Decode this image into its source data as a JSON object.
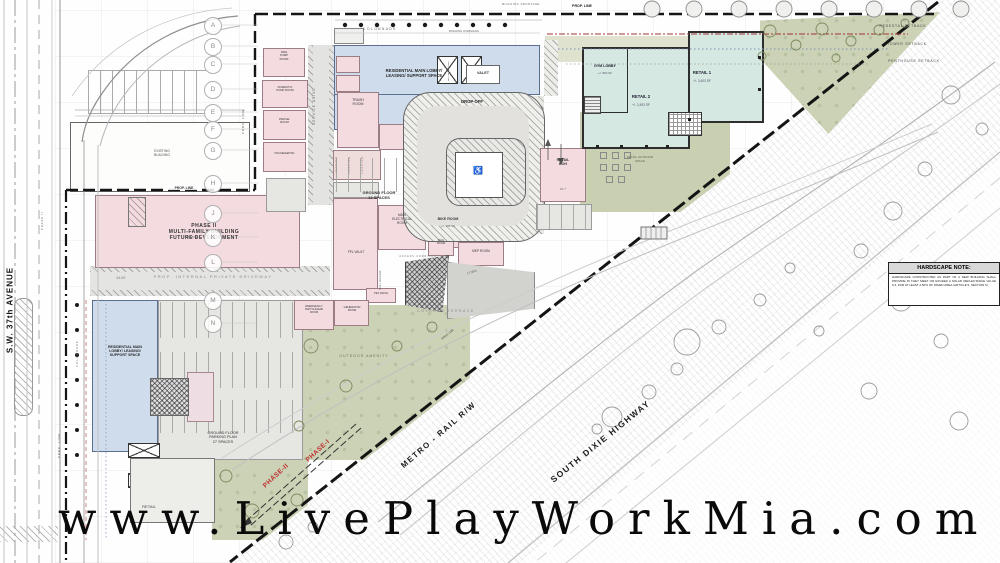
{
  "watermark": "www.LivePlayWorkMia.com",
  "roads": {
    "sw37": "S.W. 37th AVENUE",
    "metro": "METRO - RAIL  R/W",
    "dixie": "SOUTH DIXIE HIGHWAY",
    "colonnade_top": "COLONNADE",
    "colonnade_left": "COLONNADE",
    "service_drive": "SERVICE DRIVE",
    "internal_driveway": "PROP.  INTERNAL  PRIVATE  DRIVEWAY"
  },
  "boundary": {
    "prop_line": "PROP. LINE",
    "building_frontage": "BUILDING FRONTAGE",
    "building_overhang": "BUILDING OVERHANG",
    "pedestal_setback": "PEDESTAL SETBACK",
    "tower_setback": "TOWER SETBACK",
    "penthouse_setback": "PENTHOUSE SETBACK"
  },
  "phase": {
    "phase2": "PHASE-II",
    "phase1": "PHASE-I",
    "phase2_small": "PHASE II"
  },
  "grid_letters": [
    "A",
    "B",
    "C",
    "D",
    "E",
    "F",
    "G",
    "H",
    "J",
    "K",
    "L",
    "M",
    "N"
  ],
  "buildings": {
    "existing": "EXISTING\nBUILDING",
    "phase2_future": "PHASE II\nMULTI-FAMILY BUILDING\nFUTURE DEVELOPMENT",
    "res_lobby_top": "RESIDENTIAL MAIN LOBBY/\nLEASING/ SUPPORT SPACE",
    "res_lobby_left": "RESIDENTIAL MAIN\nLOBBY/ LEASING/\nSUPPORT SPACE",
    "gym_lobby": "GYM LOBBY",
    "gym_lobby_area": "+/- 952 SF",
    "retail1": "RETAIL 1",
    "retail1_area": "+/- 3,403 SF",
    "retail2": "RETAIL 2",
    "retail2_area": "+/- 2,493 SF",
    "retail_boh": "RETAIL\nBOH",
    "retail_bottom": "RETAIL"
  },
  "rooms": {
    "trash": "TRASH\nROOM",
    "fire_pump": "FIRE\nPUMP\nROOM",
    "domestic_pump": "DOMESTIC\nPUMP ROOM",
    "parcel": "PARCEL\nROOM",
    "housekeeping": "HOUSEKEEPING",
    "main_electrical": "MAIN\nELECTRICAL\nROOM",
    "fpl_vault": "FPL VAULT",
    "bike": "BIKE ROOM",
    "bike_area": "+/- 436 SF",
    "bag": "BAG\nROOM",
    "mep": "MEP ROOM",
    "pet_wash": "PET WASH",
    "generator": "GENERATOR\nROOM",
    "emergency": "EMERGENCY\nSWITCHGEAR\nROOM",
    "access_corridor": "ACCESS CORRIDOR",
    "mail_package": "MAIL / PACKAGE",
    "valet": "VALET",
    "res_elev": "RES. ELEV. LOBBY",
    "loading": "LOADING",
    "service": "SERVICE"
  },
  "areas": {
    "drop_off": "DROP-OFF",
    "ground_12": "GROUND FLOOR\n12 SPACES",
    "parking_27": "GROUND FLOOR\nPARKING PLAN\n27 SPACES",
    "outdoor_amenity": "OUTDOOR AMENITY",
    "covered_terrace": "COVERED TERRACE",
    "retail_outdoor": "RETAIL OUTDOOR\nSPACE"
  },
  "dims": {
    "driveway": "24.00'",
    "boh": "28.7'",
    "ramp": "17.35%"
  },
  "note": {
    "title": "HARDSCAPE NOTE:",
    "body": "HARDSCAPE CONSTRUCTED AS PART OF A NEW BUILDING SHALL PROVIDE IN THEY MEET OR EXCEED A SOLAR REFLECTANCE VALUE 0.3, FOR AT LEAST A 50% OF PAVED AREA (ARTICLE 5, SECTION 5)."
  }
}
